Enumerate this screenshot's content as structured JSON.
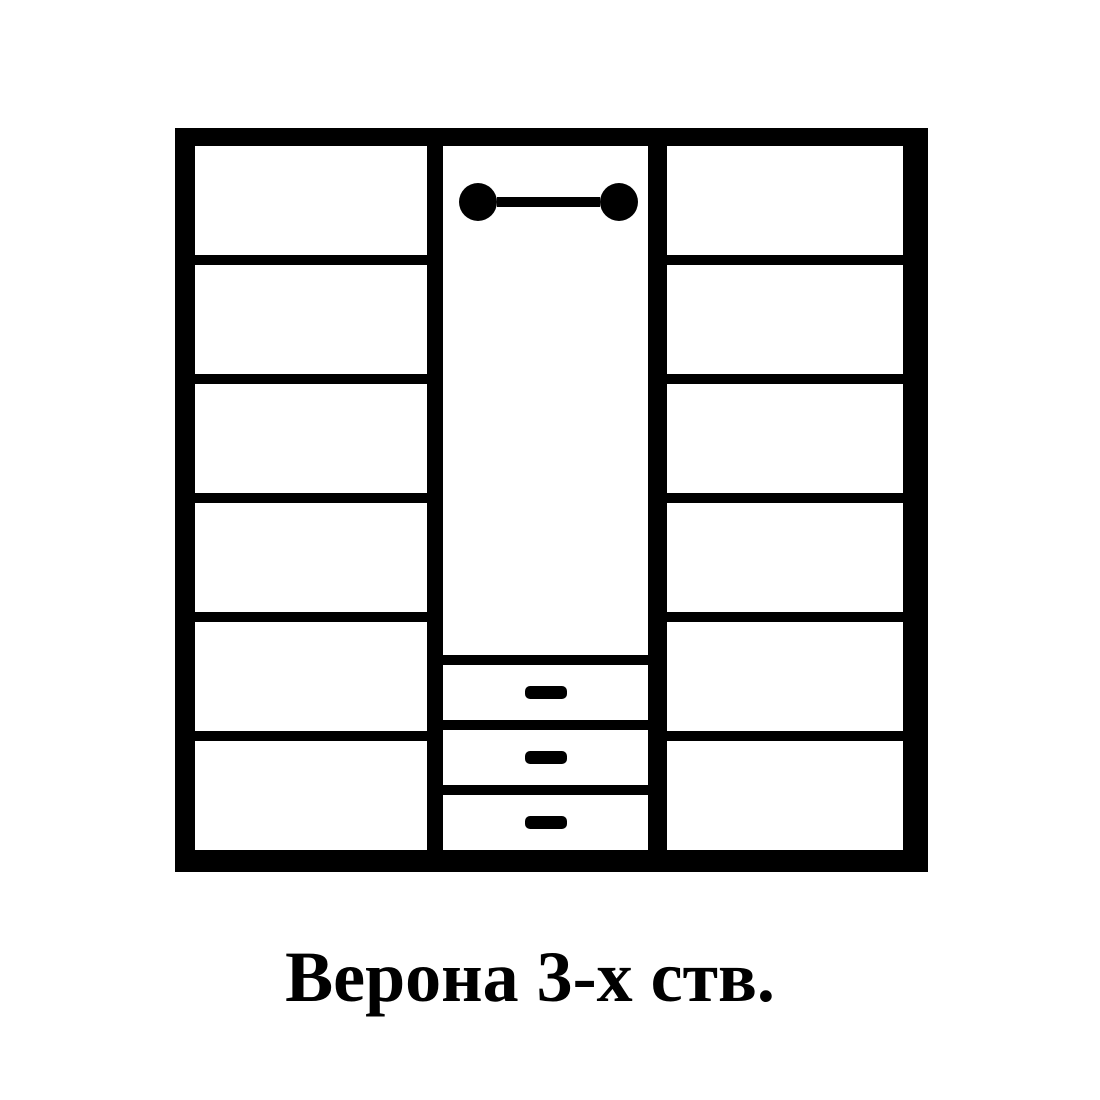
{
  "page": {
    "background": "#ffffff"
  },
  "diagram": {
    "caption": "Верона 3-х ств.",
    "colors": {
      "line": "#000000",
      "fill": "#ffffff"
    },
    "wardrobe": {
      "left_column": {
        "type": "shelves",
        "shelf_count": 6
      },
      "center_column": {
        "hanger_rod": true,
        "drawer_count": 3
      },
      "right_column": {
        "type": "shelves",
        "shelf_count": 6
      }
    }
  }
}
